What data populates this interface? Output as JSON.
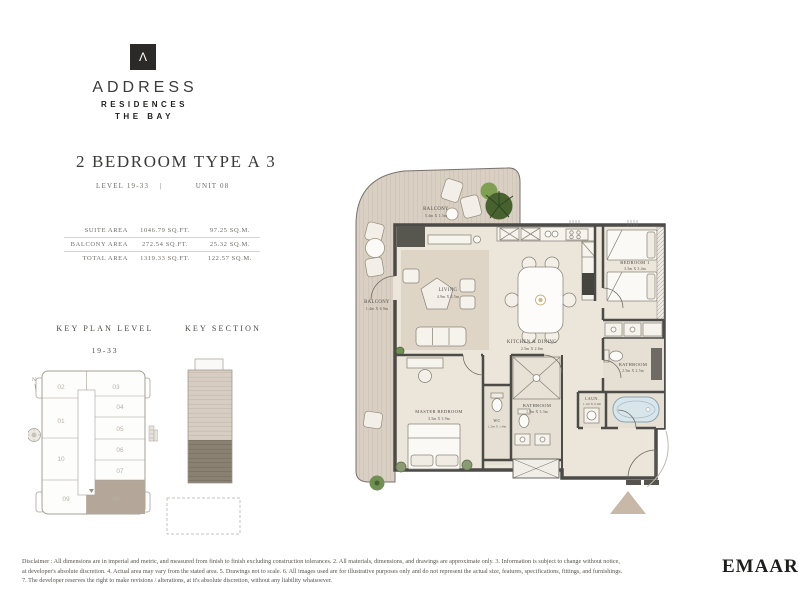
{
  "brand": {
    "mark": "Λ",
    "name": "ADDRESS",
    "line1": "RESIDENCES",
    "line2": "THE BAY"
  },
  "header": {
    "title": "2 BEDROOM TYPE A 3",
    "level": "LEVEL 19-33",
    "divider": "|",
    "unit": "UNIT 08"
  },
  "area_table": {
    "rows": [
      {
        "label": "SUITE AREA",
        "sqft": "1046.79 SQ.FT.",
        "sqm": "97.25 SQ.M."
      },
      {
        "label": "BALCONY AREA",
        "sqft": "272.54 SQ.FT.",
        "sqm": "25.32 SQ.M."
      },
      {
        "label": "TOTAL AREA",
        "sqft": "1319.33 SQ.FT.",
        "sqm": "122.57 SQ.M."
      }
    ]
  },
  "key_plan": {
    "title": "KEY PLAN LEVEL",
    "subtitle": "19-33",
    "north": "N",
    "units": [
      "02",
      "03",
      "01",
      "04",
      "05",
      "10",
      "06",
      "07",
      "09",
      "08"
    ],
    "highlighted_unit": "08"
  },
  "key_section": {
    "title": "KEY SECTION"
  },
  "floor_plan": {
    "balcony_top": {
      "name": "BALCONY",
      "dims": "5.4m X 1.5m"
    },
    "balcony_side": {
      "name": "BALCONY",
      "dims": "1.4m X 6.9m"
    },
    "living": {
      "name": "LIVING",
      "dims": "4.9m X 4.5m"
    },
    "kitchen_dining": {
      "name": "KITCHEN & DINING",
      "dims": "2.5m X 2.6m"
    },
    "bedroom_1": {
      "name": "BEDROOM 1",
      "dims": "3.5m X 3.4m"
    },
    "bathroom_2": {
      "name": "BATHROOM",
      "dims": "2.5m X 2.5m"
    },
    "laundry": {
      "name": "LAUN.",
      "dims": "1.1m X 0.9m"
    },
    "master_bedroom": {
      "name": "MASTER BEDROOM",
      "dims": "3.5m X 3.9m"
    },
    "wc": {
      "name": "WC",
      "dims": "1.2m X 1.4m"
    },
    "bathroom_1": {
      "name": "BATHROOM",
      "dims": "1.9m X 3.3m"
    }
  },
  "footer": {
    "disclaimer_lines": [
      "Disclaimer : All dimensions are in imperial and metric, and measured from finish to finish excluding construction tolerances. 2. All materials, dimensions, and drawings are approximate only. 3. Information is subject to change without notice,",
      "at developer's absolute discretion. 4. Actual area may vary from the stated area. 5. Drawings not to scale. 6. All images used are for illustrative purposes only and do not represent the actual size, features, specifications, fittings, and furnishings.",
      "7. The developer reserves the right to make revisions / alterations, at it's absolute discretion, without any liability whatsoever."
    ],
    "developer_logo": "EMAAR"
  },
  "colors": {
    "wall": "#4c4b47",
    "floor": "#ebe5da",
    "balcony_deck": "#d9cfc3",
    "rug": "#ded5c6",
    "highlight_unit": "#b4a698",
    "section_light": "#d7cdc2",
    "section_dark": "#8a8173",
    "plant_green": "#48622f",
    "tub_blue": "#d8e6ec"
  }
}
